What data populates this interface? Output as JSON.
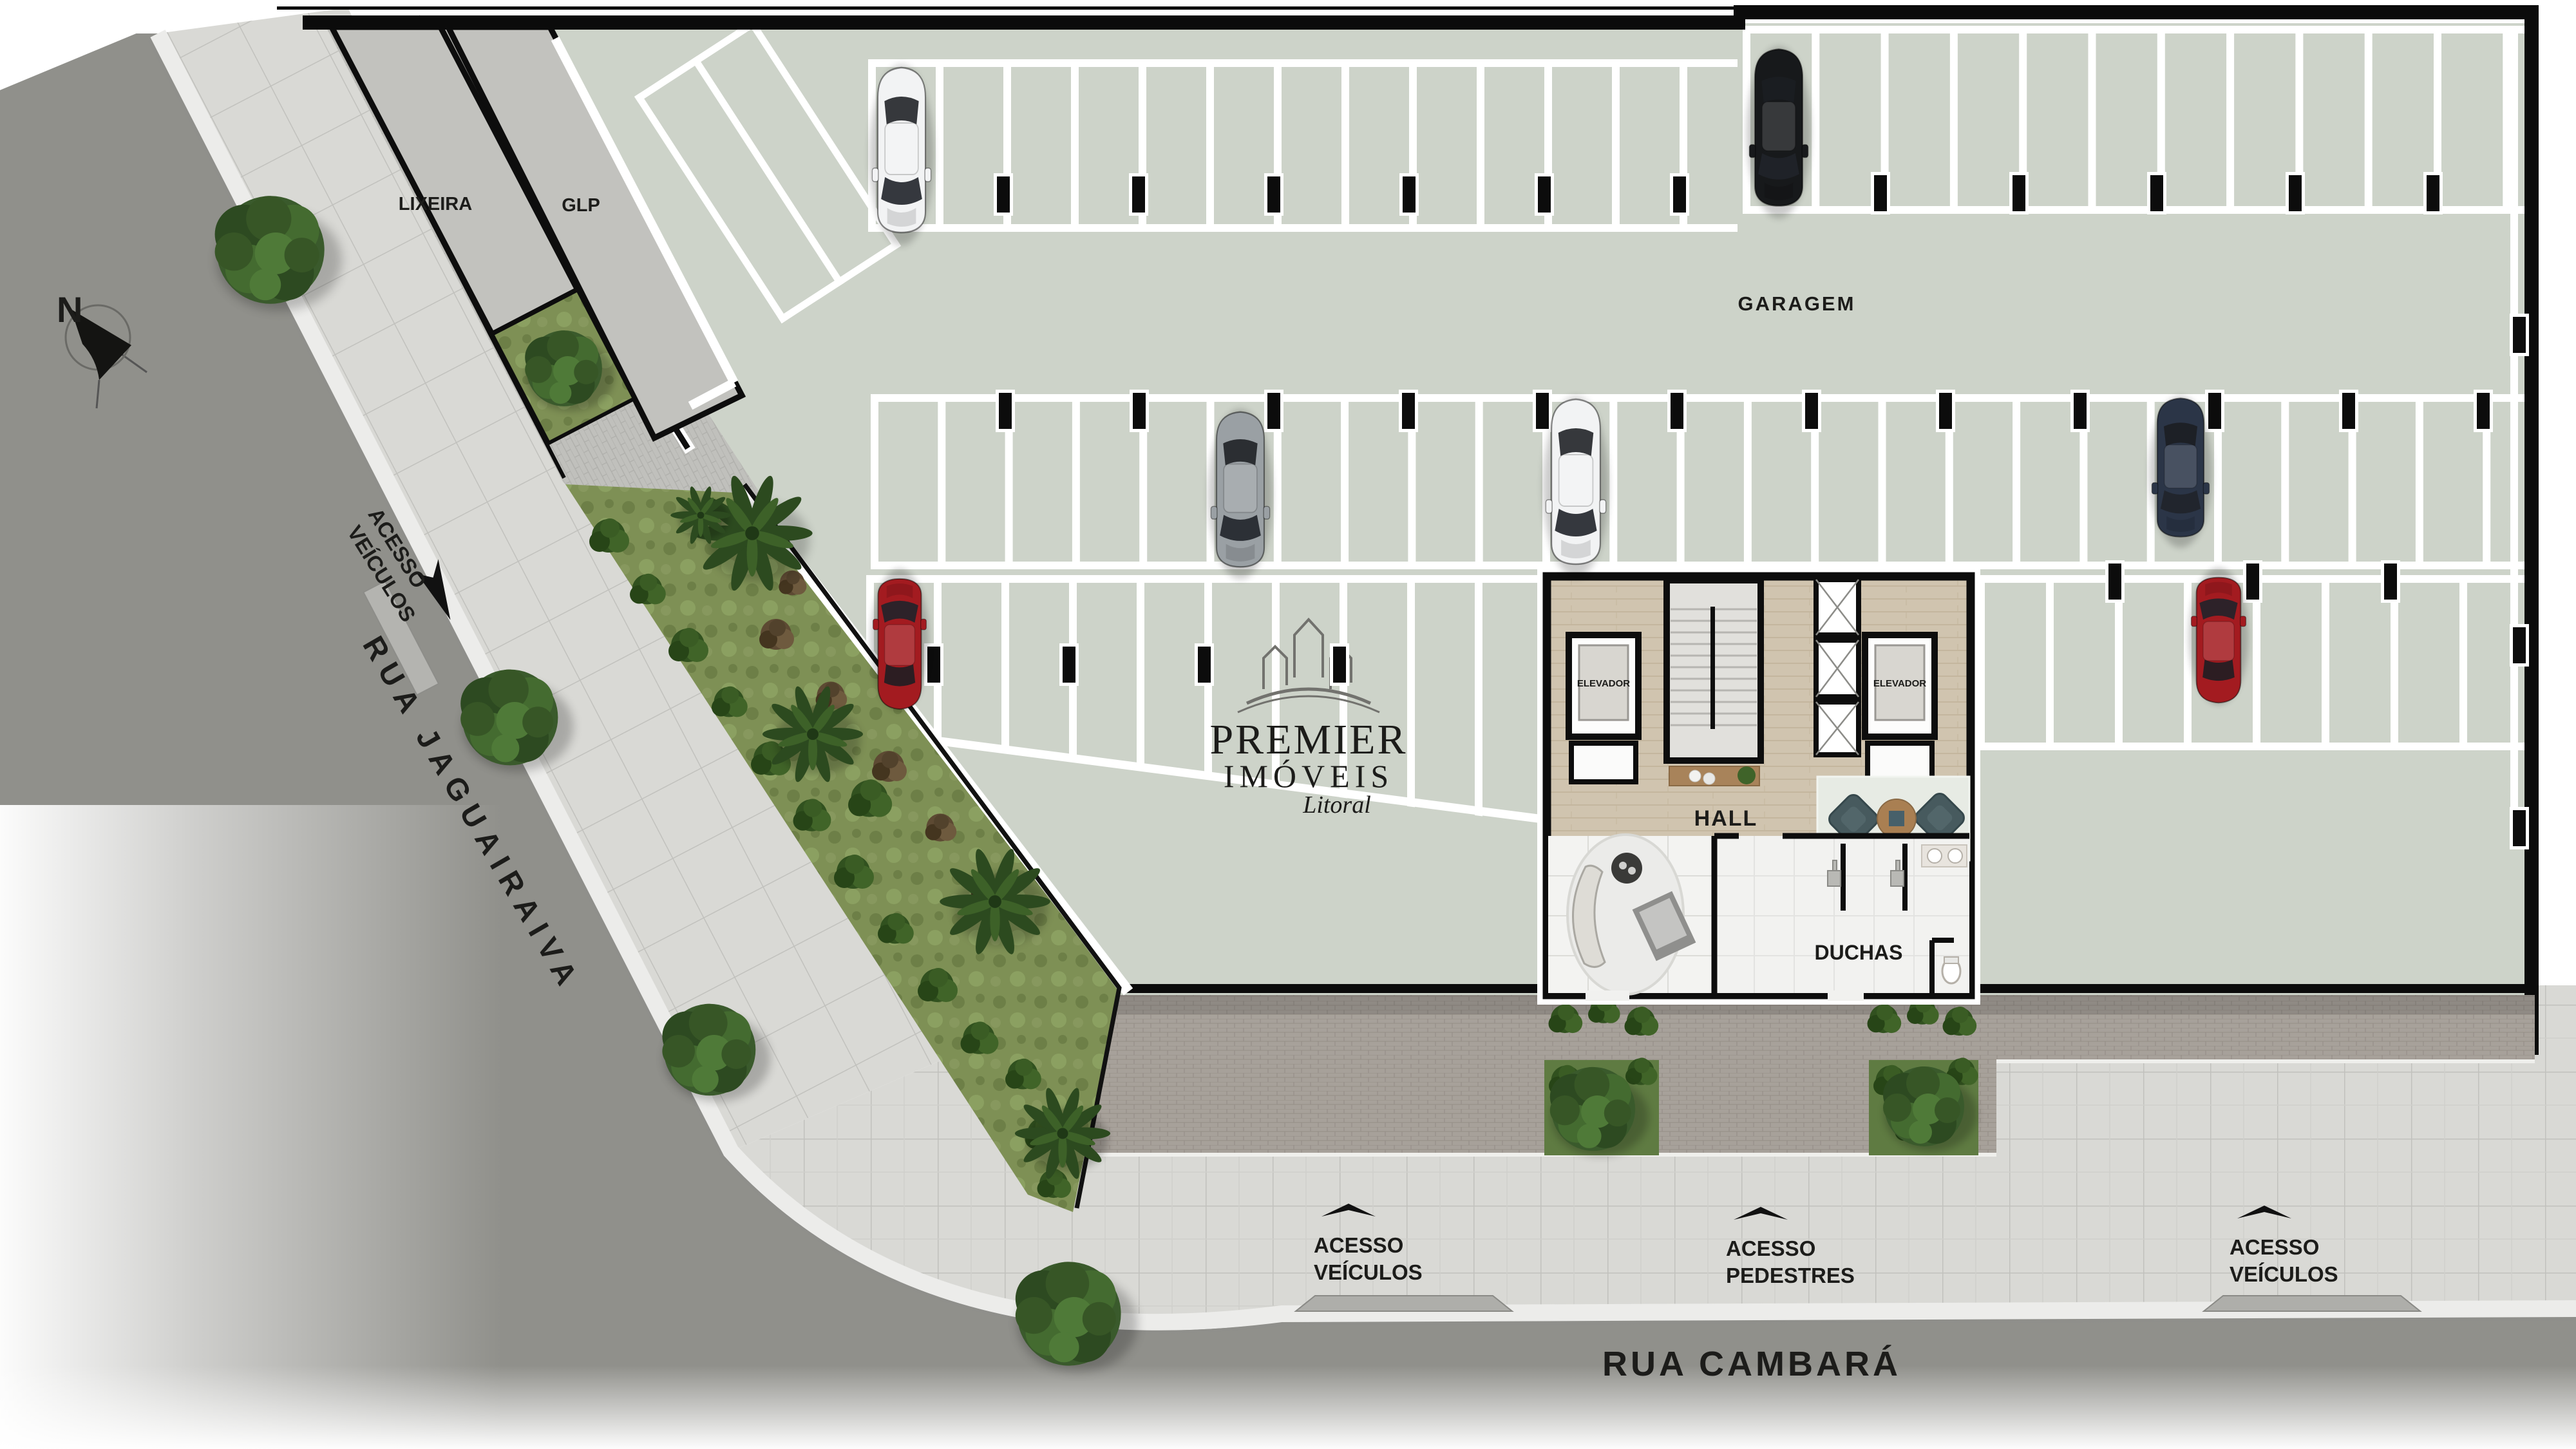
{
  "compass": {
    "n": "N"
  },
  "streets": {
    "left": {
      "name": "RUA  JAGUAIRAIVA"
    },
    "bottom": {
      "name": "RUA CAMBARÁ"
    }
  },
  "areas": {
    "garage": "GARAGEM",
    "trash": "LIXEIRA",
    "gas": "GLP",
    "hall": "HALL",
    "showers": "DUCHAS",
    "elevator": "ELEVADOR"
  },
  "access": {
    "street_vehicles": {
      "l1": "ACESSO",
      "l2": "VEÍCULOS"
    },
    "bottom_vehicles_left": {
      "l1": "ACESSO",
      "l2": "VEÍCULOS"
    },
    "bottom_pedestrians": {
      "l1": "ACESSO",
      "l2": "PEDESTRES"
    },
    "bottom_vehicles_right": {
      "l1": "ACESSO",
      "l2": "VEÍCULOS"
    }
  },
  "logo": {
    "l1": "PREMIER",
    "l2": "IMÓVEIS",
    "l3": "Litoral"
  },
  "cars": [
    {
      "color": "#f2f3f4",
      "spot": "top-row-left"
    },
    {
      "color": "#17191b",
      "spot": "top-row-right"
    },
    {
      "color": "#9aa0a4",
      "spot": "middle-row-left"
    },
    {
      "color": "#f2f3f4",
      "spot": "middle-row-center"
    },
    {
      "color": "#2b3547",
      "spot": "middle-row-right"
    },
    {
      "color": "#a31b20",
      "spot": "lower-row-left"
    },
    {
      "color": "#a31b20",
      "spot": "lower-row-right"
    }
  ],
  "colors": {
    "garage_floor": "#cdd3c9",
    "street": "#90908b",
    "sidewalk": "#d9d9d5",
    "terrace_pavers": "#a7a19a",
    "court_pavers": "#c0c0bc",
    "grass": "#7e9055",
    "hedge": "#44632e",
    "wood_floor": "#d0c4af",
    "wall": "#0d0d0d",
    "stall_line": "#ffffff",
    "logo_gray": "#72726e"
  }
}
